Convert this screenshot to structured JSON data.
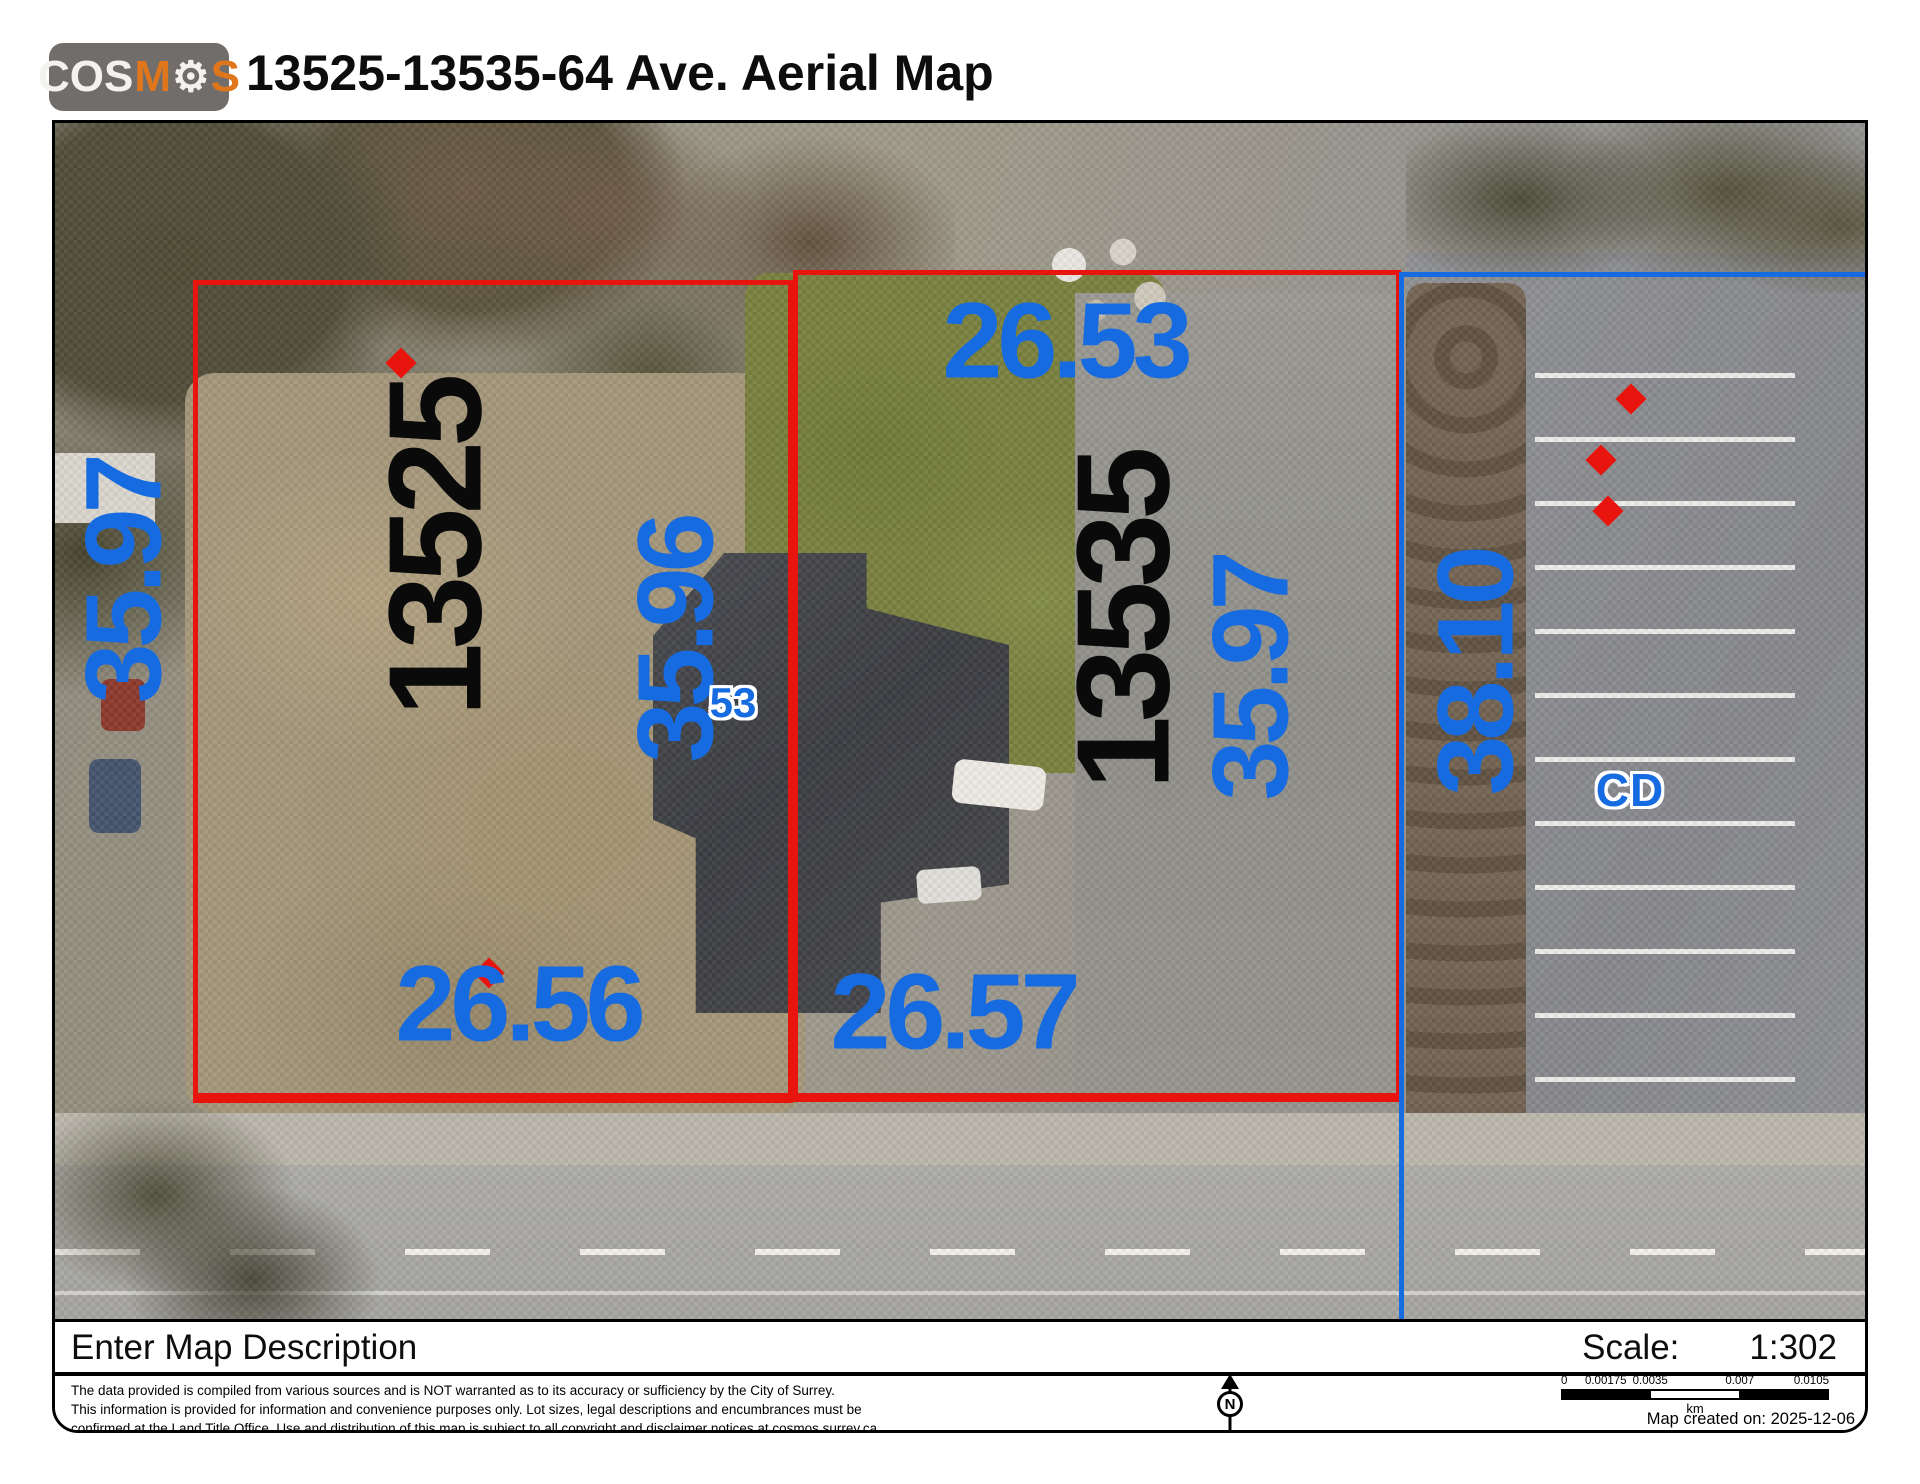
{
  "header": {
    "logo": {
      "part1": "COS",
      "part2": "M",
      "gear_icon": "⚙",
      "part3": "S"
    },
    "title": "13525-13535-64 Ave. Aerial Map"
  },
  "map": {
    "parcels": [
      {
        "number": "13525"
      },
      {
        "number": "13535"
      }
    ],
    "dimensions": {
      "right_parcel_top": "26.53",
      "left_parcel_bottom": "26.56",
      "right_parcel_bottom": "26.57",
      "left_parcel_side_west": "35.97",
      "left_parcel_side_east": "35.96",
      "right_parcel_side_east": "35.97",
      "adjacent_lot_side": "38.10"
    },
    "zone_label": "CD",
    "small_lot_label": "53"
  },
  "footer": {
    "description": "Enter Map Description",
    "scale_label": "Scale:",
    "scale_value": "1:302",
    "disclaimer": [
      "The data provided is compiled from various sources and is NOT warranted as to its accuracy or sufficiency by the City of Surrey.",
      "This information is provided for information and convenience purposes only.  Lot sizes, legal descriptions and encumbrances must be",
      "confirmed at the Land Title Office.  Use and distribution of this map is subject to all copyright and disclaimer notices at cosmos.surrey.ca"
    ],
    "north_letter": "N",
    "scalebar": {
      "ticks": [
        "0",
        "0.00175",
        "0.0035",
        "0.007",
        "0.0105"
      ],
      "unit": "km"
    },
    "created": "Map created on: 2025-12-06"
  },
  "colors": {
    "parcel_outline_red": "#e8150f",
    "annotation_blue": "#176be0",
    "parcel_number_black": "#0a0a0a",
    "logo_orange": "#e0761c",
    "logo_gray": "#716d6a"
  }
}
